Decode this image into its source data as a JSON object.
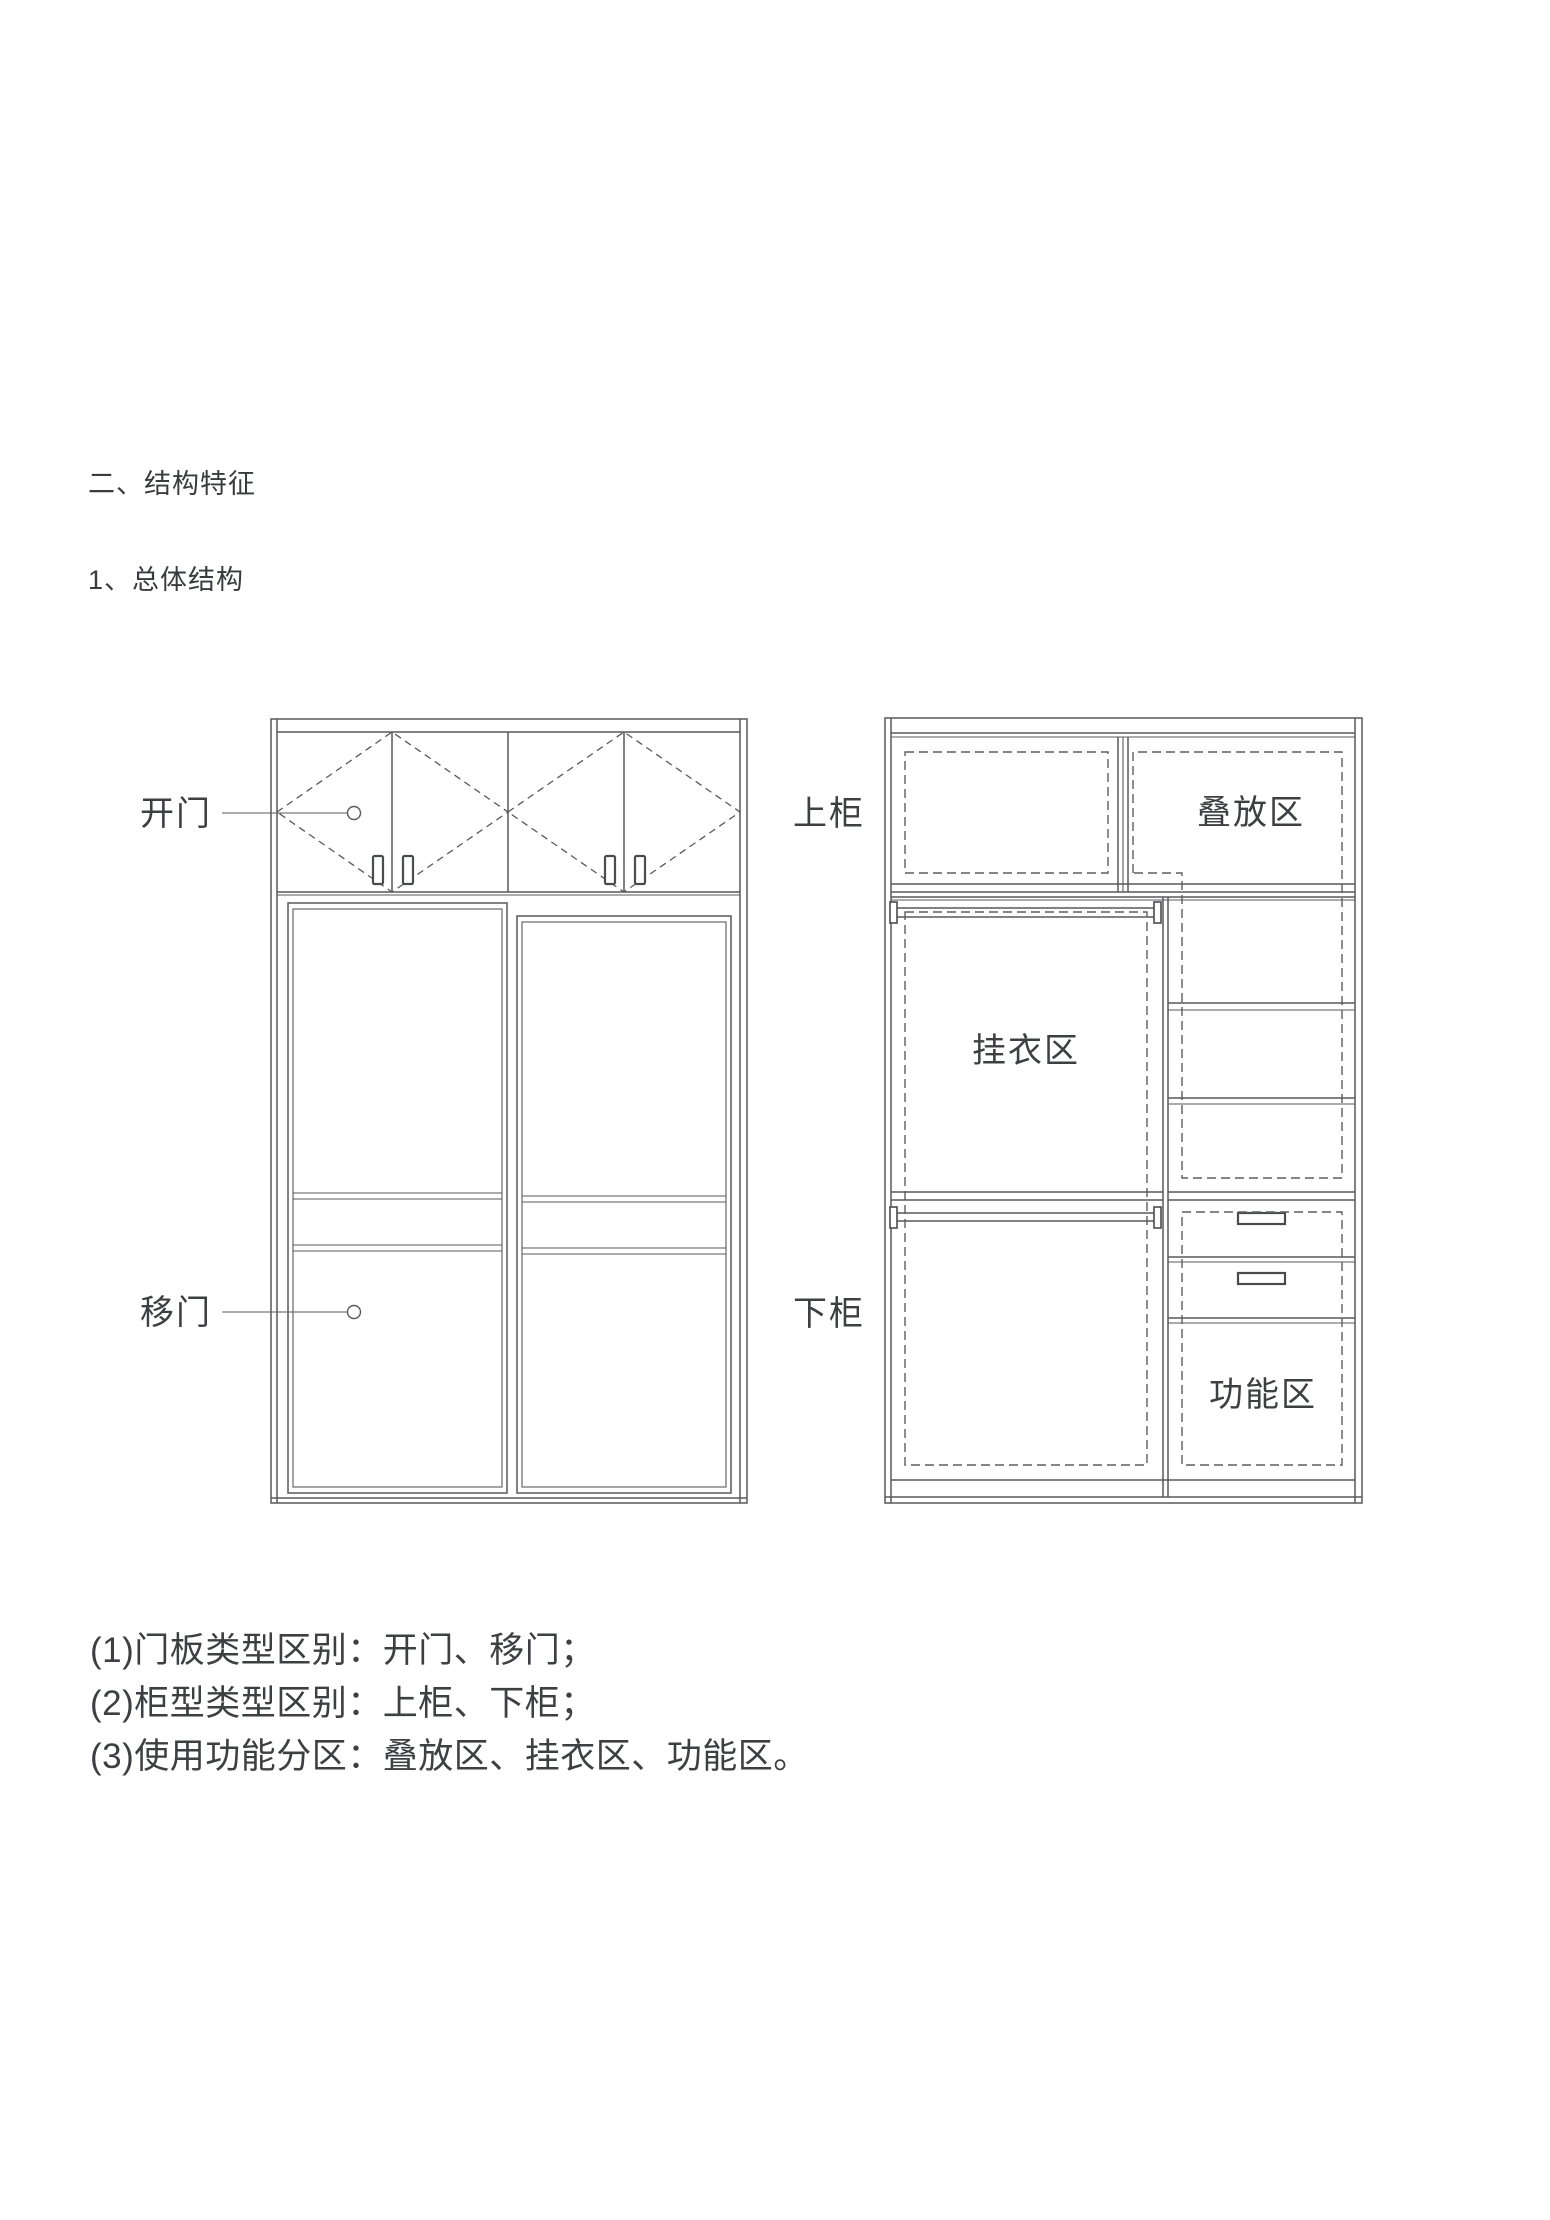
{
  "page": {
    "section_title": "二、结构特征",
    "subsection_title": "1、总体结构"
  },
  "diagram": {
    "left_wardrobe": {
      "labels": {
        "hinged_door": "开门",
        "sliding_door": "移门"
      }
    },
    "right_wardrobe": {
      "labels": {
        "upper_cabinet": "上柜",
        "lower_cabinet": "下柜",
        "stacking_zone": "叠放区",
        "hanging_zone": "挂衣区",
        "functional_zone": "功能区"
      }
    }
  },
  "notes": {
    "items": [
      "(1)门板类型区别：开门、移门；",
      "(2)柜型类型区别：上柜、下柜；",
      "(3)使用功能分区：叠放区、挂衣区、功能区。"
    ]
  },
  "colors": {
    "line": "#58595b",
    "dashed_line": "#5d5e60",
    "text": "#3e3f42",
    "background": "#ffffff"
  }
}
